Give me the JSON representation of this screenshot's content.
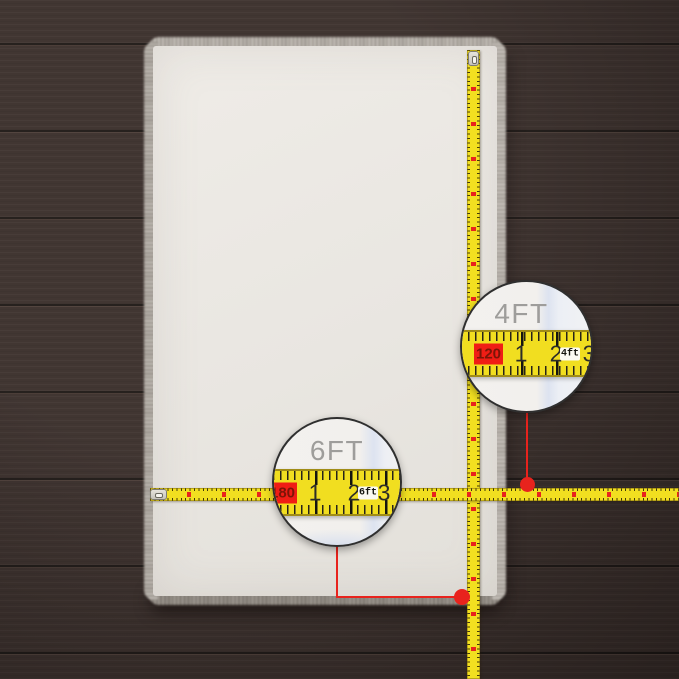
{
  "scene": {
    "subject": "white-faux-fur-rug-on-dark-wood-plank-floor",
    "colors": {
      "floor_wood": "#372c29",
      "plank_gap": "#1d1412",
      "rug": "#eae7e2",
      "fur_fringe": "#b3aea8",
      "tape_yellow": "#f2df20",
      "accent_red": "#e8231d",
      "magnifier_label_gray": "#9e9d9b",
      "magnifier_bg": "#f3f1ee",
      "magnified_shadow_blue": "#dde3f0"
    }
  },
  "callouts": [
    {
      "id": "width-4ft",
      "label": "4FT",
      "tape": {
        "cm_value": "120",
        "tick_numbers": [
          "1",
          "2",
          "3"
        ],
        "unit_tag": "4ft"
      }
    },
    {
      "id": "length-6ft",
      "label": "6FT",
      "tape": {
        "cm_value": "180",
        "tick_numbers": [
          "1",
          "2",
          "3"
        ],
        "unit_tag": "6ft"
      }
    }
  ]
}
